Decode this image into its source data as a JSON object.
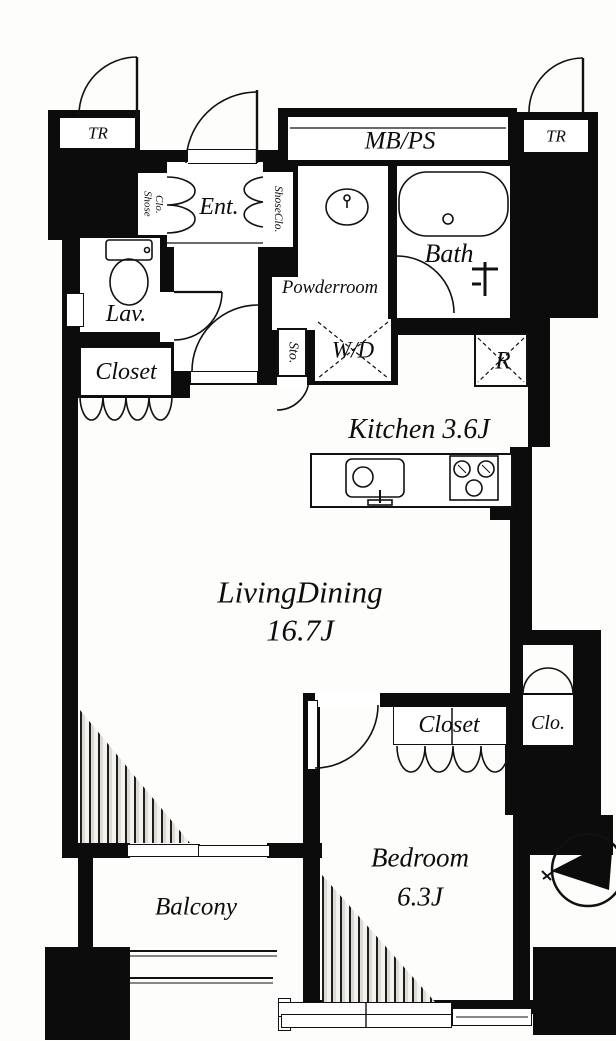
{
  "floorplan": {
    "labels": {
      "tr_left": "TR",
      "tr_right": "TR",
      "mb_ps": "MB/PS",
      "entrance": "Ent.",
      "shoe_closet_left_line1": "Shose",
      "shoe_closet_left_line2": "Clo.",
      "shoe_closet_right": "ShoseClo.",
      "powder_room": "Powderroom",
      "bath": "Bath",
      "lavatory": "Lav.",
      "closet_left": "Closet",
      "storage": "Sto.",
      "washer_dryer": "W/D",
      "refrigerator": "R",
      "kitchen": "Kitchen 3.6J",
      "living_dining_name": "LivingDining",
      "living_dining_area": "16.7J",
      "bedroom_closet": "Closet",
      "bedroom_clo": "Clo.",
      "bedroom_name": "Bedroom",
      "bedroom_area": "6.3J",
      "balcony": "Balcony"
    }
  }
}
